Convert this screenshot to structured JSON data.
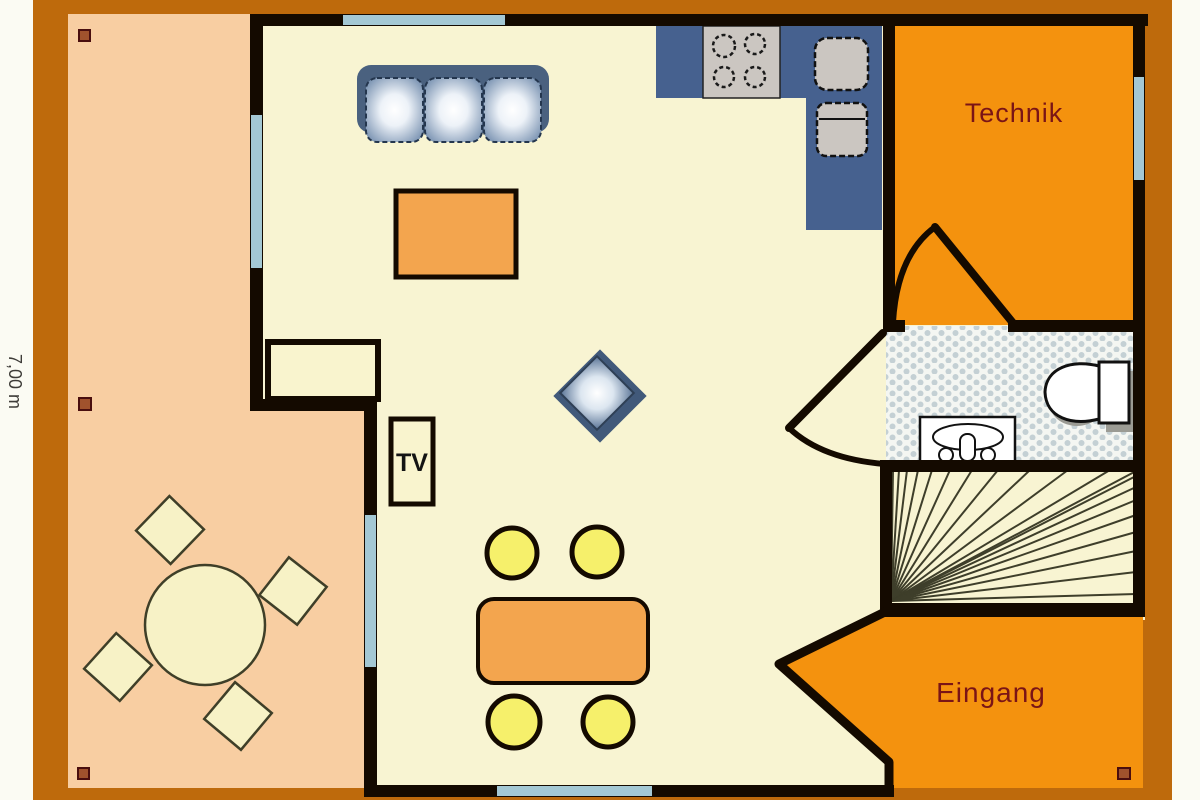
{
  "plan": {
    "labels": {
      "technik": "Technik",
      "eingang": "Eingang",
      "tv": "TV",
      "dimension_left": "7,00 m"
    },
    "colors": {
      "outer_frame": "#BE6A0C",
      "page_margin": "#FBFBF3",
      "wall": "#140A00",
      "window": "#A4C8D4",
      "floor_interior": "#F8F4D2",
      "terrace": "#F8CEA2",
      "service_rooms": "#F4920E",
      "kitchen_counter": "#46618F",
      "upholstery_frame": "#4A617F",
      "table_tops": "#F3A54E",
      "dining_chairs": "#F6F06B",
      "room_label_text": "#7A1416",
      "bath_tile_dot": "#C4D0D4",
      "marker": "#A0522D"
    },
    "furniture_icons": [
      "sofa-icon",
      "coffee-table-icon",
      "sideboard-icon",
      "tv-cabinet-icon",
      "armchair-icon",
      "stove-icon",
      "kitchen-sink-icon",
      "dining-table-icon",
      "dining-chair-icon",
      "terrace-table-icon",
      "terrace-chair-icon",
      "toilet-icon",
      "washbasin-icon",
      "staircase-icon",
      "door-swing-icon",
      "entrance-arrow-icon"
    ]
  }
}
